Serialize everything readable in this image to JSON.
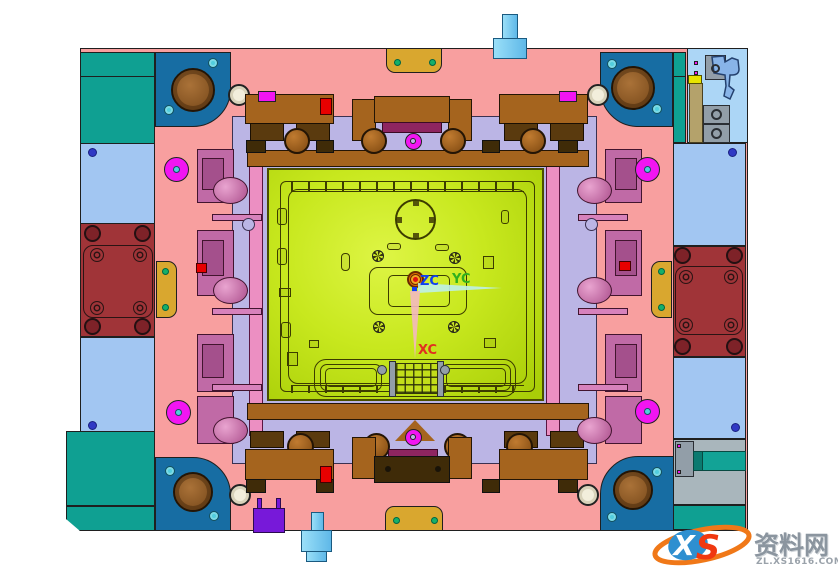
{
  "viewport": {
    "description_label": "",
    "axis_labels": {
      "x": "XC",
      "y": "YC",
      "z": "ZC"
    }
  },
  "watermark": {
    "logo_x": "X",
    "logo_s": "S",
    "site_name": "资料网",
    "site_url": "ZL.XS1616.COM"
  },
  "colors": {
    "outline": "#1f1f1f",
    "plate_pink": "#F89F9F",
    "corner_blue": "#176DA3",
    "teal": "#0FA092",
    "light_blue": "#A2C6F2",
    "panel_blue": "#ACD6F6",
    "lavender": "#BBB5E5",
    "brick_red": "#A03438",
    "gold": "#D9A72F",
    "green_dot": "#15B06A",
    "core_light": "#DEF545",
    "core_mid": "#C8E81E",
    "core_dark": "#A9CE08",
    "core_line": "#3C3C00",
    "magenta": "#F215F2",
    "cyan_dot": "#52CEDE",
    "slider_pink": "#D782BC",
    "slider_mid": "#C06AA6",
    "slider_dark": "#A4508C",
    "maroon": "#8E2560",
    "brown": "#A5641E",
    "brown_dark": "#5A3A0E",
    "brown_deep": "#3F2B08",
    "red_marker": "#E80000",
    "purple": "#7719D9",
    "cyan_fitting": "#77CEF2",
    "cream": "#F2EEDC",
    "dark_blue_dot": "#3038C4",
    "gray": "#A9B6BC",
    "gray_block": "#929EA8",
    "teal_cyl": "#12A396",
    "tan": "#B4A26B",
    "yellow": "#E8E400",
    "latch_blue": "#88B4E8",
    "arrow_cyan": "#BEEFE8",
    "arrow_pink": "#F3B8C0",
    "label_blue": "#1040F0",
    "label_green": "#2FB01E",
    "label_red": "#E03020",
    "sprue_orange": "#E07000",
    "sprue_red": "#E01010",
    "wm_orange": "#F07818",
    "wm_blue": "#2E8FD0",
    "wm_red": "#F03810",
    "wm_gray": "#8B959F"
  }
}
